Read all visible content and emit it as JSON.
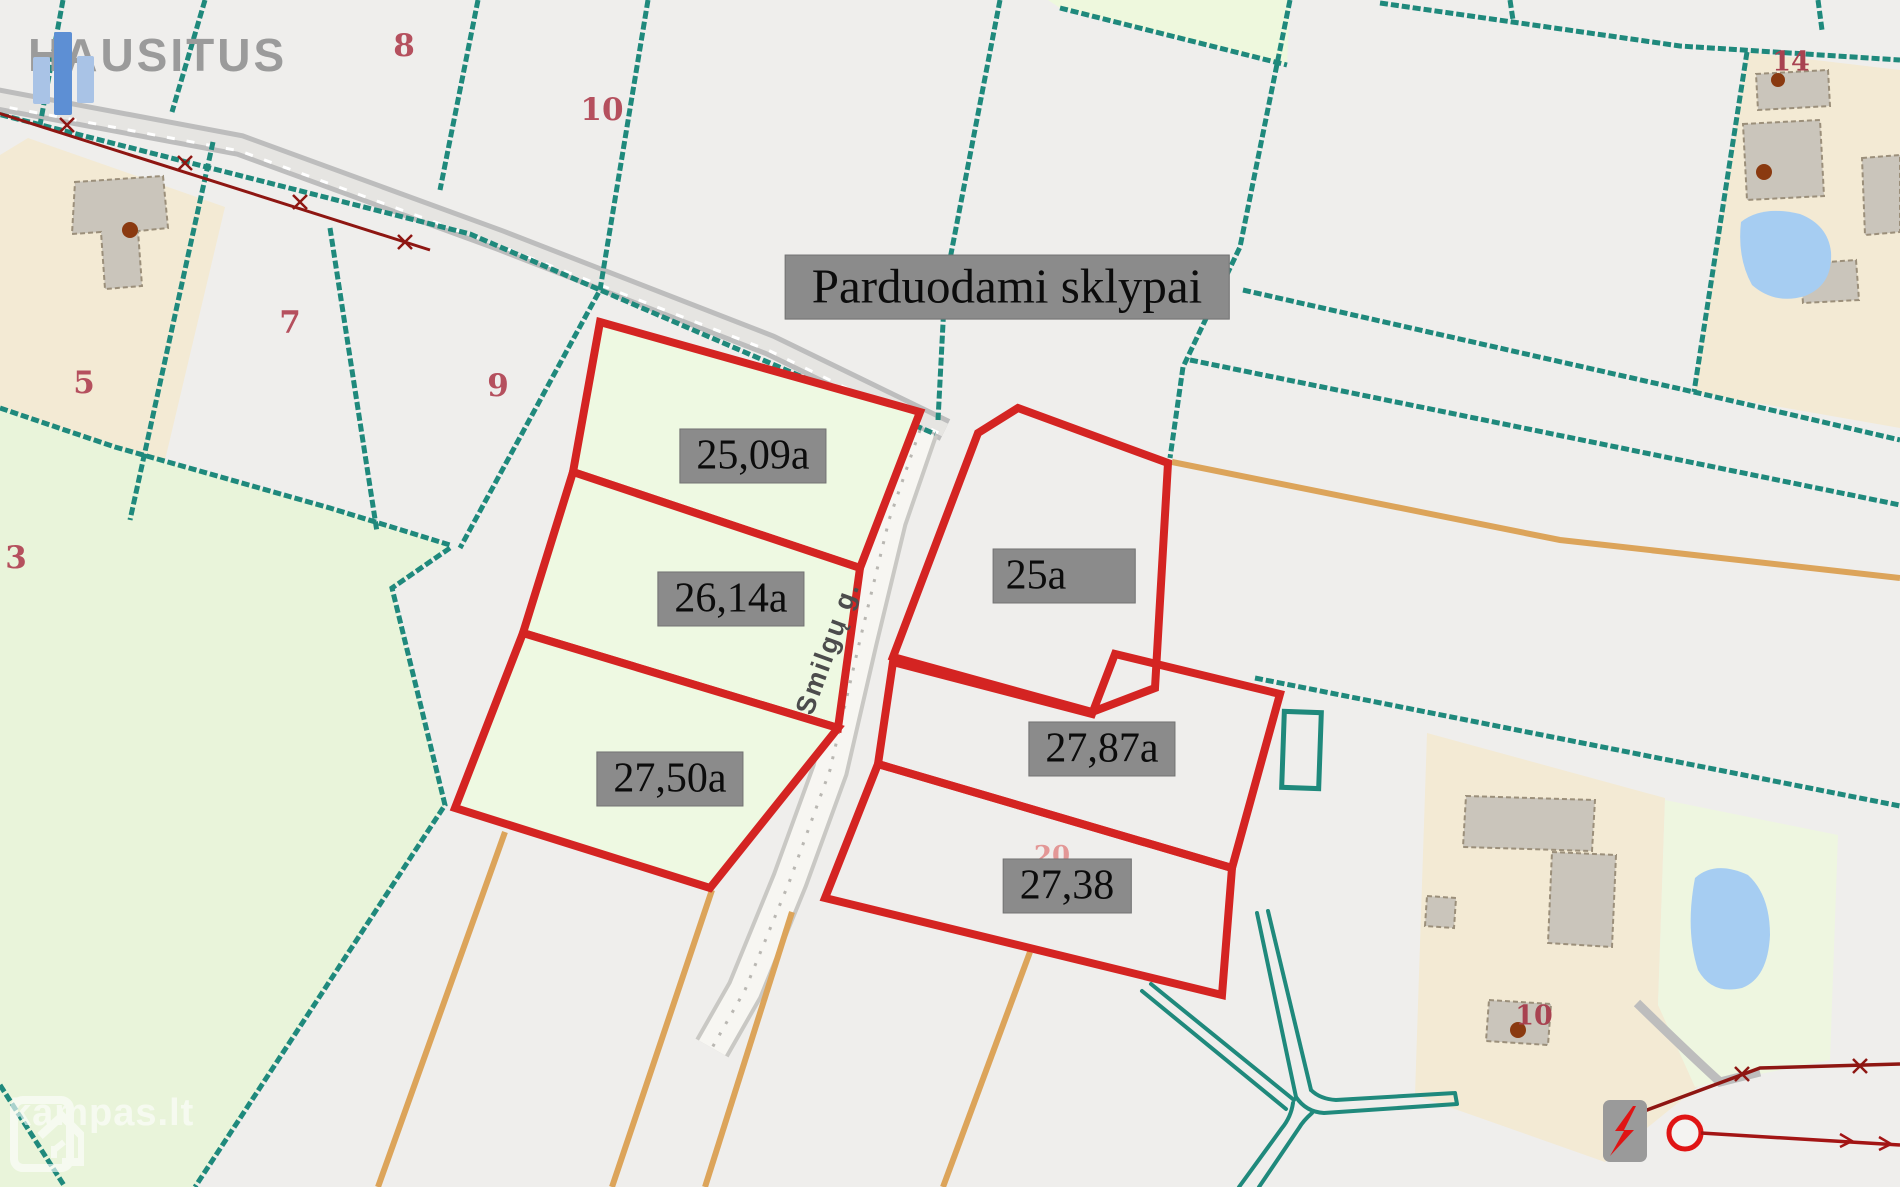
{
  "branding": {
    "logo_text": "HAUSITUS",
    "watermark_text": "kampas.lt"
  },
  "title": {
    "text": "Parduodami sklypai"
  },
  "street": {
    "name": "Smilgų g."
  },
  "plots_for_sale": [
    {
      "id": "plot-1",
      "area_label": "25,09a"
    },
    {
      "id": "plot-2",
      "area_label": "26,14a"
    },
    {
      "id": "plot-3",
      "area_label": "27,50a"
    },
    {
      "id": "plot-4",
      "area_label": "25a"
    },
    {
      "id": "plot-5",
      "area_label": "27,87a"
    },
    {
      "id": "plot-6",
      "area_label": "27,38"
    }
  ],
  "parcel_numbers": {
    "n8": "8",
    "n10_top": "10",
    "n5": "5",
    "n7": "7",
    "n9": "9",
    "n3": "3",
    "n14": "14",
    "n10_bottom": "10",
    "n20_faint": "20"
  },
  "colors": {
    "sale_border_red": "#d42422",
    "boundary_teal": "#1f897c",
    "power_line_red": "#8e1612",
    "utility_orange": "#dca45a",
    "label_box_gray": "#8b8b8b",
    "sale_plot_green": "#eef9e2",
    "pond_blue": "#a6cdf2",
    "building_gray": "#cac5bb",
    "farmland_beige": "#f3ead4"
  }
}
